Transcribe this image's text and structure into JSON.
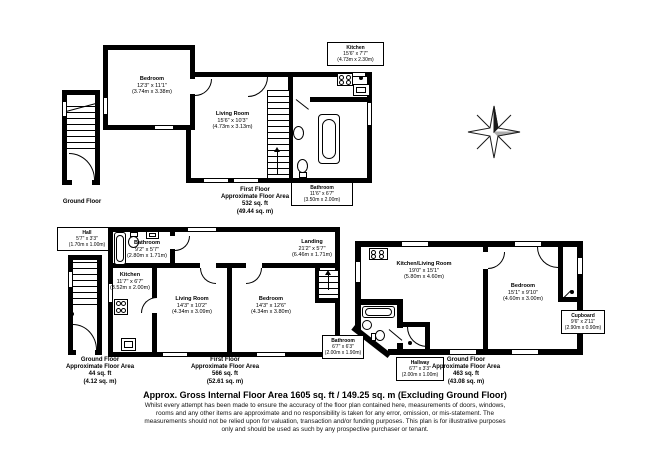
{
  "page": {
    "heading": "Approx. Gross Internal Floor Area 1605 sq. ft / 149.25 sq. m (Excluding Ground Floor)",
    "disclaimer": [
      "Whilst every attempt has been made to ensure the accuracy of the floor plan contained here, measurements of doors, windows,",
      "rooms and any other items are approximate and no responsibility is taken for any error, omission, or mis-statement. The",
      "measurements should not be relied upon for valuation, transaction and/or funding purposes. This plan is for illustrative purposes",
      "only and should be used as such by any prospective purchaser or tenant."
    ]
  },
  "colors": {
    "wall": "#000000",
    "background": "#ffffff"
  },
  "fixtures": [
    "bathtub-icon",
    "toilet-icon",
    "sink-icon",
    "stove-icon",
    "staircase",
    "compass-rose-icon"
  ],
  "plan_top": {
    "ground_label": "Ground Floor",
    "bedroom": {
      "name": "Bedroom",
      "imp": "12'3\" x 11'1\"",
      "met": "(3.74m x 3.38m)"
    },
    "living": {
      "name": "Living Room",
      "imp": "15'6\" x 10'3\"",
      "met": "(4.73m x 3.13m)"
    },
    "kitchen": {
      "name": "Kitchen",
      "imp": "15'6\" x 7'7\"",
      "met": "(4.73m x 2.30m)"
    },
    "bathroom": {
      "name": "Bathroom",
      "imp": "11'6\" x 6'7\"",
      "met": "(3.50m x 2.00m)"
    },
    "area": [
      "First Floor",
      "Approximate Floor Area",
      "532 sq. ft",
      "(49.44 sq. m)"
    ]
  },
  "plan_left": {
    "hall": {
      "name": "Hall",
      "imp": "5'7\" x 3'3\"",
      "met": "(1.70m x 1.00m)"
    },
    "area": [
      "Ground Floor",
      "Approximate Floor Area",
      "44 sq. ft",
      "(4.12 sq. m)"
    ]
  },
  "plan_mid": {
    "bathroom": {
      "name": "Bathroom",
      "imp": "9'2\" x 5'7\"",
      "met": "(2.80m x 1.71m)"
    },
    "kitchen": {
      "name": "Kitchen",
      "imp": "11'7\" x 6'7\"",
      "met": "(3.52m x 2.00m)"
    },
    "living": {
      "name": "Living Room",
      "imp": "14'3\" x 10'2\"",
      "met": "(4.34m x 3.09m)"
    },
    "bedroom": {
      "name": "Bedroom",
      "imp": "14'3\" x 12'6\"",
      "met": "(4.34m x 3.80m)"
    },
    "landing": {
      "name": "Landing",
      "imp": "21'2\" x 5'7\"",
      "met": "(6.46m x 1.71m)"
    },
    "area": [
      "First Floor",
      "Approximate Floor Area",
      "566 sq. ft",
      "(52.61 sq. m)"
    ]
  },
  "plan_right": {
    "kitchen_living": {
      "name": "Kitchen/Living Room",
      "imp": "19'0\" x 15'1\"",
      "met": "(5.80m x 4.60m)"
    },
    "bedroom": {
      "name": "Bedroom",
      "imp": "15'1\" x 9'10\"",
      "met": "(4.60m x 3.00m)"
    },
    "cupboard": {
      "name": "Cupboard",
      "imp": "9'6\" x 2'11\"",
      "met": "(2.90m x 0.90m)"
    },
    "bathroom": {
      "name": "Bathroom",
      "imp": "6'7\" x 6'3\"",
      "met": "(2.00m x 1.90m)"
    },
    "hallway": {
      "name": "Hallway",
      "imp": "6'7\" x 3'3\"",
      "met": "(2.00m x 1.00m)"
    },
    "area": [
      "Ground Floor",
      "Approximate Floor Area",
      "463 sq. ft",
      "(43.08 sq. m)"
    ]
  }
}
